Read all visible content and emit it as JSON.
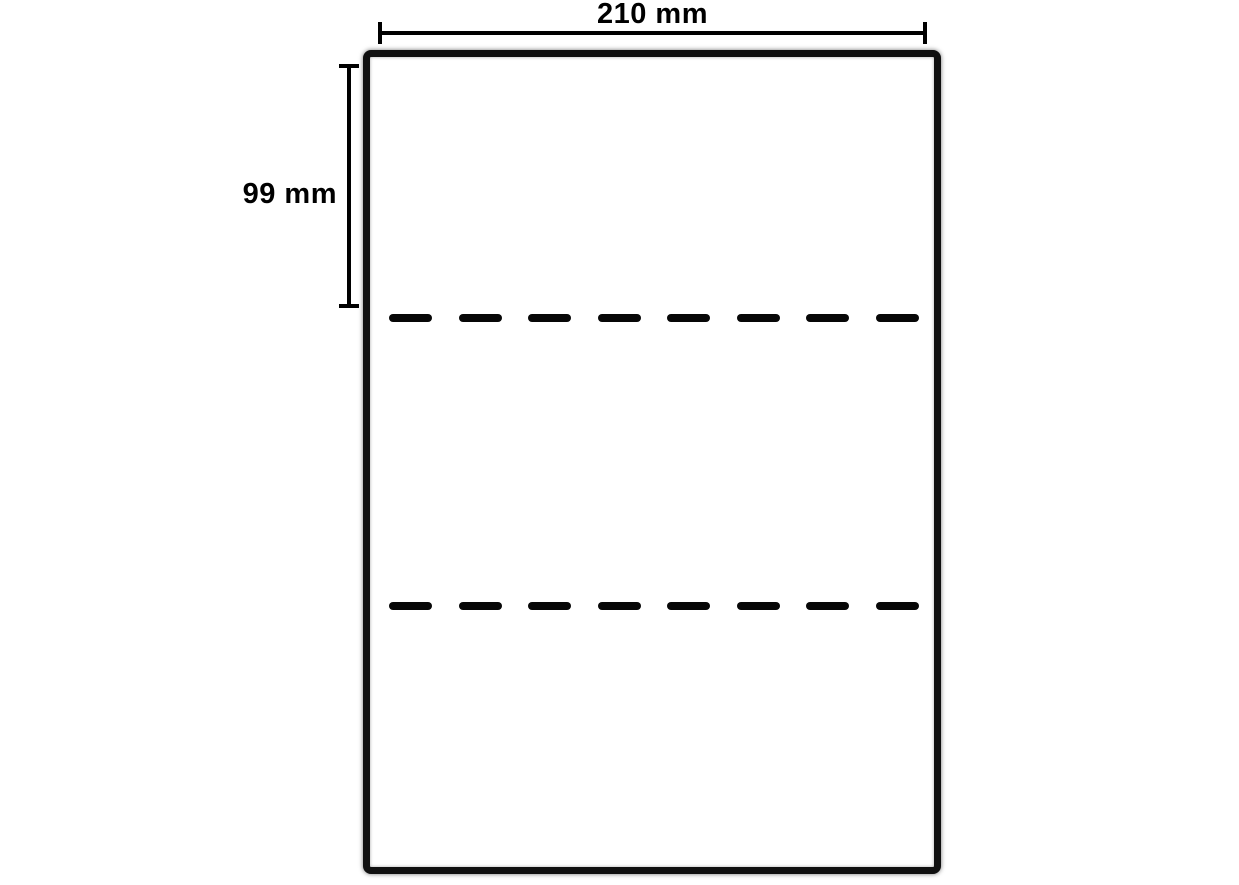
{
  "dimensions": {
    "width": {
      "label": "210 mm"
    },
    "section_height": {
      "label": "99 mm"
    }
  },
  "sheet": {
    "perforation_line_count": 2,
    "dashes_per_line": 8
  },
  "colors": {
    "ink": "#000000",
    "sheet_border": "#101010",
    "background": "#ffffff"
  }
}
